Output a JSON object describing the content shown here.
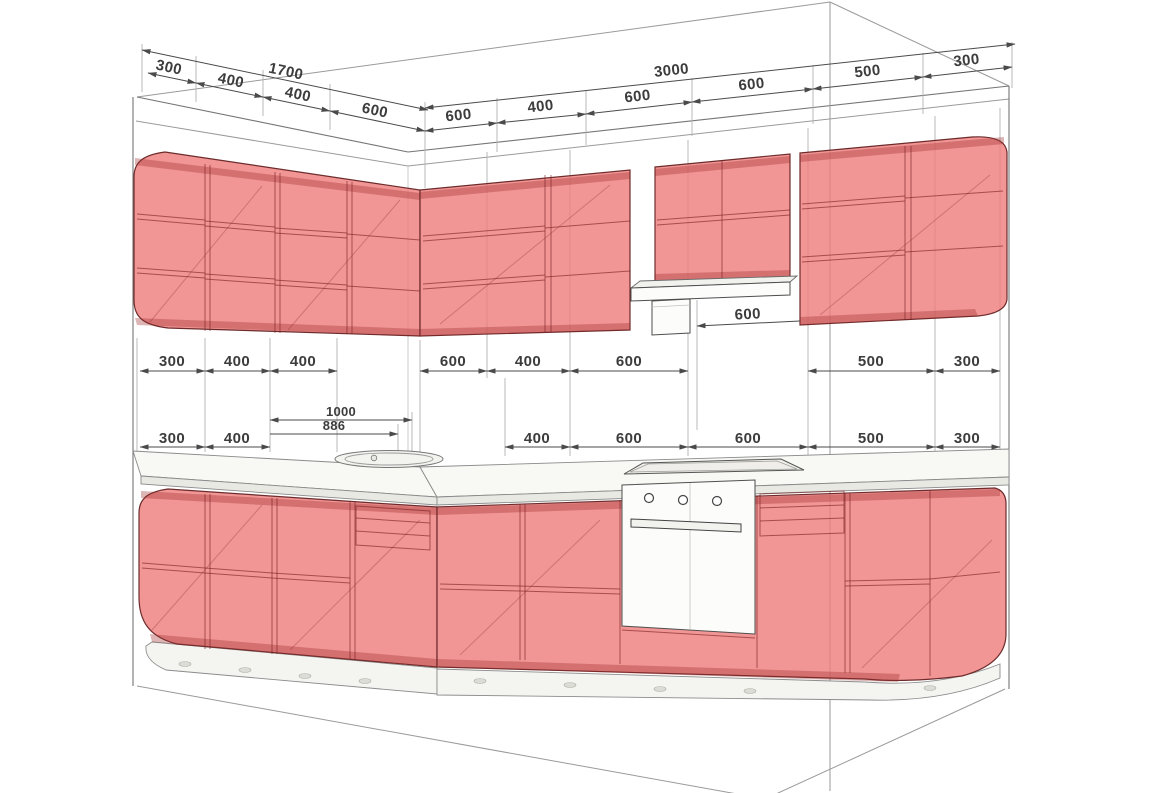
{
  "colors": {
    "cabinet_fill": "#ee7b7b",
    "cabinet_edge": "#6d2b2b",
    "counter_top": "#f8f8f4",
    "appliance_white": "#fcfcfa",
    "dim_text": "#3c3c3c",
    "wireframe": "#9a9a9a"
  },
  "dims": {
    "top_left": {
      "total": "1700",
      "segments": [
        "300",
        "400",
        "400",
        "600"
      ]
    },
    "top_right": {
      "total": "3000",
      "segments": [
        "600",
        "400",
        "600",
        "600",
        "500",
        "300"
      ]
    },
    "mid": {
      "left": [
        "300",
        "400",
        "400"
      ],
      "right": [
        "600",
        "400",
        "600"
      ],
      "far": [
        "500",
        "300"
      ]
    },
    "hood": {
      "width": "600"
    },
    "lower": {
      "left": [
        "300",
        "400"
      ],
      "sink_width": "886",
      "sink_offset": "1000",
      "right": [
        "400",
        "600",
        "600"
      ],
      "far": [
        "500",
        "300"
      ]
    }
  }
}
